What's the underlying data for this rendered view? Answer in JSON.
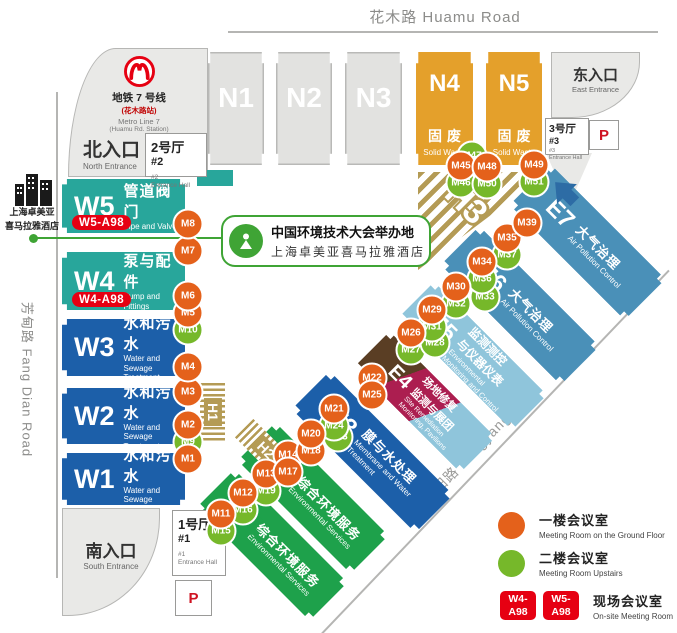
{
  "roads": {
    "huamu": "花木路 Huamu Road",
    "fangdian": "芳甸路  Fang Dian Road",
    "longyang": "龙阳路  Longyang Road"
  },
  "metro": {
    "line1": "地铁 7 号线",
    "line2": "(花木路站)",
    "line3": "Metro Line 7",
    "line4": "(Huamu Rd. Station)"
  },
  "entrances": {
    "north": {
      "zh": "北入口",
      "en": "North Entrance"
    },
    "south": {
      "zh": "南入口",
      "en": "South Entrance"
    },
    "east": {
      "zh": "东入口",
      "en": "East Entrance"
    }
  },
  "entrance_halls": {
    "h1": {
      "zh": "1号厅",
      "no": "#1",
      "en": "Entrance Hall"
    },
    "h2": {
      "zh": "2号厅",
      "no": "#2",
      "en": "Entrance Hall"
    },
    "h3": {
      "zh": "3号厅",
      "no": "#3",
      "en": "Entrance Hall"
    }
  },
  "parking": {
    "label": "P"
  },
  "hotel": {
    "name_line1": "上海卓美亚",
    "name_line2": "喜马拉雅酒店",
    "callout_line1": "中国环境技术大会举办地",
    "callout_line2": "上海卓美亚喜马拉雅酒店"
  },
  "halls": [
    {
      "id": "N1"
    },
    {
      "id": "N2"
    },
    {
      "id": "N3"
    },
    {
      "id": "N4",
      "zh_lines": [
        "固废"
      ],
      "en_lines": [
        "Solid Waste"
      ]
    },
    {
      "id": "N5",
      "zh_lines": [
        "固废"
      ],
      "en_lines": [
        "Solid Waste"
      ]
    },
    {
      "id": "W5",
      "zh_lines": [
        "管道阀门"
      ],
      "en_lines": [
        "Pipe and Valve"
      ],
      "badge": "W5-A98"
    },
    {
      "id": "W4",
      "zh_lines": [
        "泵与配件"
      ],
      "en_lines": [
        "Pump and Fittings"
      ],
      "badge": "W4-A98"
    },
    {
      "id": "W3",
      "zh_lines": [
        "水和污水"
      ],
      "en_lines": [
        "Water and Sewage",
        "Treatment"
      ]
    },
    {
      "id": "W2",
      "zh_lines": [
        "水和污水"
      ],
      "en_lines": [
        "Water and Sewage",
        "Treatment"
      ]
    },
    {
      "id": "W1",
      "zh_lines": [
        "水和污水"
      ],
      "en_lines": [
        "Water and Sewage",
        "Treatment"
      ]
    },
    {
      "id": "E1",
      "zh_lines": [
        "综合环境服务"
      ],
      "en_lines": [
        "Environmental Services"
      ]
    },
    {
      "id": "E2",
      "zh_lines": [
        "综合环境服务"
      ],
      "en_lines": [
        "Environmental Services"
      ]
    },
    {
      "id": "E3",
      "zh_lines": [
        "膜与水处理"
      ],
      "en_lines": [
        "Membrane and Water",
        "Treatment"
      ]
    },
    {
      "id": "E4",
      "zh_lines": [
        "场地修复",
        "监测与展团"
      ],
      "en_lines": [
        "Site Remediation",
        "Monitoring, Pavilions"
      ]
    },
    {
      "id": "E5",
      "zh_lines": [
        "监测测控",
        "与仪器仪表"
      ],
      "en_lines": [
        "Environmental",
        "Monitoring and Control"
      ]
    },
    {
      "id": "E6",
      "zh_lines": [
        "大气治理"
      ],
      "en_lines": [
        "Air Pollution Control"
      ]
    },
    {
      "id": "E7",
      "zh_lines": [
        "大气治理"
      ],
      "en_lines": [
        "Air Pollution Control"
      ]
    }
  ],
  "temp_halls": [
    "H1",
    "H2",
    "H3"
  ],
  "markers": [
    {
      "id": "M1",
      "floor": "ground",
      "x": 188,
      "y": 459
    },
    {
      "id": "M2",
      "floor": "ground",
      "x": 188,
      "y": 425
    },
    {
      "id": "M3",
      "floor": "ground",
      "x": 188,
      "y": 392
    },
    {
      "id": "M4",
      "floor": "ground",
      "x": 188,
      "y": 367
    },
    {
      "id": "M5",
      "floor": "ground",
      "x": 188,
      "y": 313
    },
    {
      "id": "M6",
      "floor": "ground",
      "x": 188,
      "y": 296
    },
    {
      "id": "M7",
      "floor": "ground",
      "x": 188,
      "y": 251
    },
    {
      "id": "M8",
      "floor": "ground",
      "x": 188,
      "y": 224
    },
    {
      "id": "M9",
      "floor": "upstairs",
      "x": 188,
      "y": 442
    },
    {
      "id": "M10",
      "floor": "upstairs",
      "x": 188,
      "y": 330
    },
    {
      "id": "M11",
      "floor": "ground",
      "x": 221,
      "y": 514
    },
    {
      "id": "M12",
      "floor": "ground",
      "x": 243,
      "y": 493
    },
    {
      "id": "M13",
      "floor": "ground",
      "x": 266,
      "y": 474
    },
    {
      "id": "M14",
      "floor": "ground",
      "x": 288,
      "y": 455
    },
    {
      "id": "M15",
      "floor": "upstairs",
      "x": 221,
      "y": 531
    },
    {
      "id": "M16",
      "floor": "upstairs",
      "x": 243,
      "y": 510
    },
    {
      "id": "M17",
      "floor": "ground",
      "x": 288,
      "y": 472
    },
    {
      "id": "M18",
      "floor": "ground",
      "x": 311,
      "y": 451
    },
    {
      "id": "M19",
      "floor": "upstairs",
      "x": 266,
      "y": 491
    },
    {
      "id": "M20",
      "floor": "ground",
      "x": 311,
      "y": 434
    },
    {
      "id": "M21",
      "floor": "ground",
      "x": 334,
      "y": 409
    },
    {
      "id": "M22",
      "floor": "ground",
      "x": 372,
      "y": 378
    },
    {
      "id": "M23",
      "floor": "upstairs",
      "x": 338,
      "y": 437
    },
    {
      "id": "M24",
      "floor": "upstairs",
      "x": 334,
      "y": 426
    },
    {
      "id": "M25",
      "floor": "ground",
      "x": 372,
      "y": 395
    },
    {
      "id": "M26",
      "floor": "ground",
      "x": 411,
      "y": 333
    },
    {
      "id": "M27",
      "floor": "upstairs",
      "x": 411,
      "y": 350
    },
    {
      "id": "M28",
      "floor": "upstairs",
      "x": 435,
      "y": 343
    },
    {
      "id": "M29",
      "floor": "ground",
      "x": 432,
      "y": 310
    },
    {
      "id": "M30",
      "floor": "ground",
      "x": 456,
      "y": 287
    },
    {
      "id": "M31",
      "floor": "upstairs",
      "x": 432,
      "y": 327
    },
    {
      "id": "M32",
      "floor": "upstairs",
      "x": 456,
      "y": 304
    },
    {
      "id": "M33",
      "floor": "upstairs",
      "x": 485,
      "y": 297
    },
    {
      "id": "M34",
      "floor": "ground",
      "x": 482,
      "y": 262
    },
    {
      "id": "M35",
      "floor": "ground",
      "x": 507,
      "y": 238
    },
    {
      "id": "M36",
      "floor": "upstairs",
      "x": 482,
      "y": 279
    },
    {
      "id": "M37",
      "floor": "upstairs",
      "x": 507,
      "y": 255
    },
    {
      "id": "M39",
      "floor": "ground",
      "x": 527,
      "y": 223
    },
    {
      "id": "M45",
      "floor": "ground",
      "x": 461,
      "y": 166
    },
    {
      "id": "M46",
      "floor": "upstairs",
      "x": 461,
      "y": 183
    },
    {
      "id": "M47",
      "floor": "upstairs",
      "x": 472,
      "y": 156
    },
    {
      "id": "M48",
      "floor": "ground",
      "x": 487,
      "y": 167
    },
    {
      "id": "M49",
      "floor": "ground",
      "x": 534,
      "y": 165
    },
    {
      "id": "M50",
      "floor": "upstairs",
      "x": 487,
      "y": 184
    },
    {
      "id": "M51",
      "floor": "upstairs",
      "x": 534,
      "y": 182
    }
  ],
  "legend": {
    "ground": {
      "zh": "一楼会议室",
      "en": "Meeting Room on the Ground Floor",
      "color": "#E4611B"
    },
    "upstairs": {
      "zh": "二楼会议室",
      "en": "Meeting Room Upstairs",
      "color": "#76B82A"
    },
    "onsite": {
      "badges": [
        "W4-A98",
        "W5-A98"
      ],
      "zh": "现场会议室",
      "en": "On-site Meeting Room",
      "color": "#E60012"
    }
  },
  "colors": {
    "marker_ground": "#E4611B",
    "marker_upstairs": "#76B82A",
    "onsite_red": "#E60012",
    "hall_teal": "#28A69B",
    "hall_blue": "#1C5FA9",
    "hall_green": "#1EA14B",
    "hall_steel": "#4A90B8",
    "hall_lightblue": "#8FC5DB",
    "hall_orange": "#E4A02B",
    "hall_brown": "#5A3E24",
    "hall_crimson": "#AC1E50",
    "hatch_tan": "#B49B55",
    "metro_red": "#E60012",
    "callout_green": "#3FA435"
  }
}
